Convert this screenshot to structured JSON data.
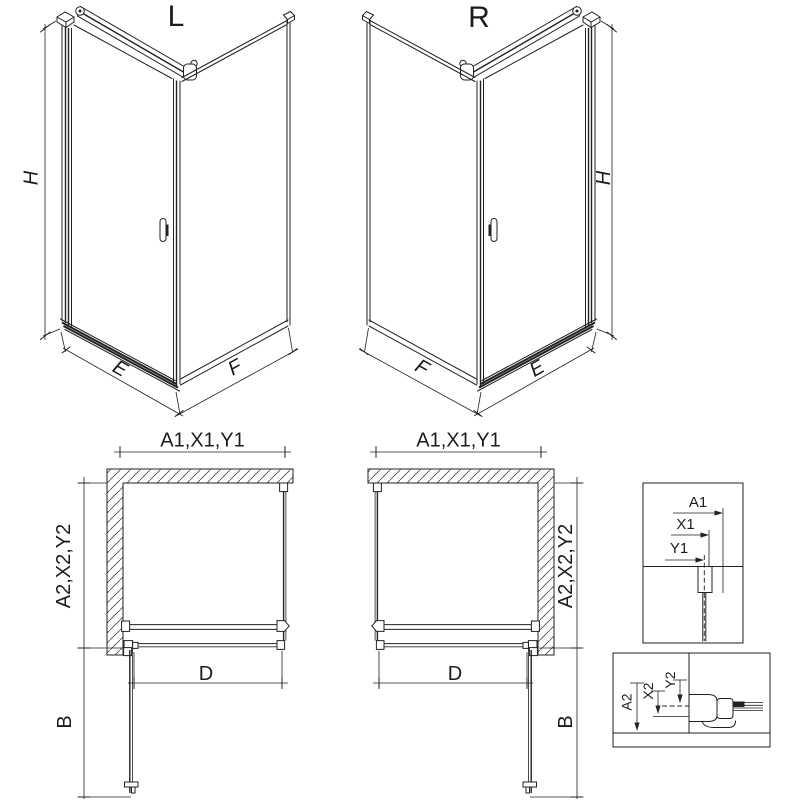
{
  "colors": {
    "line": "#222222",
    "background": "#ffffff"
  },
  "iso_views": {
    "left": {
      "label": "L",
      "height_dim": "H",
      "front_edge_dim": "E",
      "side_edge_dim": "F"
    },
    "right": {
      "label": "R",
      "height_dim": "H",
      "front_edge_dim": "E",
      "side_edge_dim": "F"
    }
  },
  "plan_views": {
    "left": {
      "width_dim": "A1,X1,Y1",
      "depth_dim": "A2,X2,Y2",
      "door_dim": "D",
      "swing_dim": "B"
    },
    "right": {
      "width_dim": "A1,X1,Y1",
      "depth_dim": "A2,X2,Y2",
      "door_dim": "D",
      "swing_dim": "B"
    }
  },
  "details": {
    "top_profile": {
      "a1": "A1",
      "x1": "X1",
      "y1": "Y1"
    },
    "bottom_profile": {
      "a2": "A2",
      "x2": "X2",
      "y2": "Y2"
    }
  }
}
